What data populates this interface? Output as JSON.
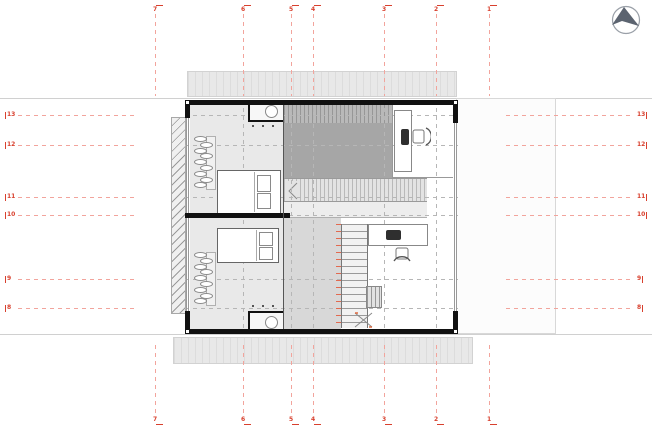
{
  "drawing": {
    "type": "architectural floor plan, upper level",
    "north_arrow_icon": "compass-north-arrow"
  },
  "colors": {
    "grid_label": "#d8402e",
    "grid_dash": "#f2a49c",
    "plan_dash": "#b6b6b6",
    "wall": "#111111",
    "void_fill": "#a6a6a6",
    "canopy_fill": "#e8e8e8",
    "north_arrow_fill": "#5c6470"
  },
  "grid": {
    "vertical": [
      {
        "label": "7",
        "x": 155
      },
      {
        "label": "6",
        "x": 243
      },
      {
        "label": "5",
        "x": 291
      },
      {
        "label": "4",
        "x": 313
      },
      {
        "label": "3",
        "x": 384
      },
      {
        "label": "2",
        "x": 436
      },
      {
        "label": "1",
        "x": 489
      }
    ],
    "horizontal": [
      {
        "label": "13",
        "y": 115
      },
      {
        "label": "12",
        "y": 145
      },
      {
        "label": "11",
        "y": 197
      },
      {
        "label": "10",
        "y": 215
      },
      {
        "label": "9",
        "y": 279
      },
      {
        "label": "8",
        "y": 308
      }
    ]
  }
}
